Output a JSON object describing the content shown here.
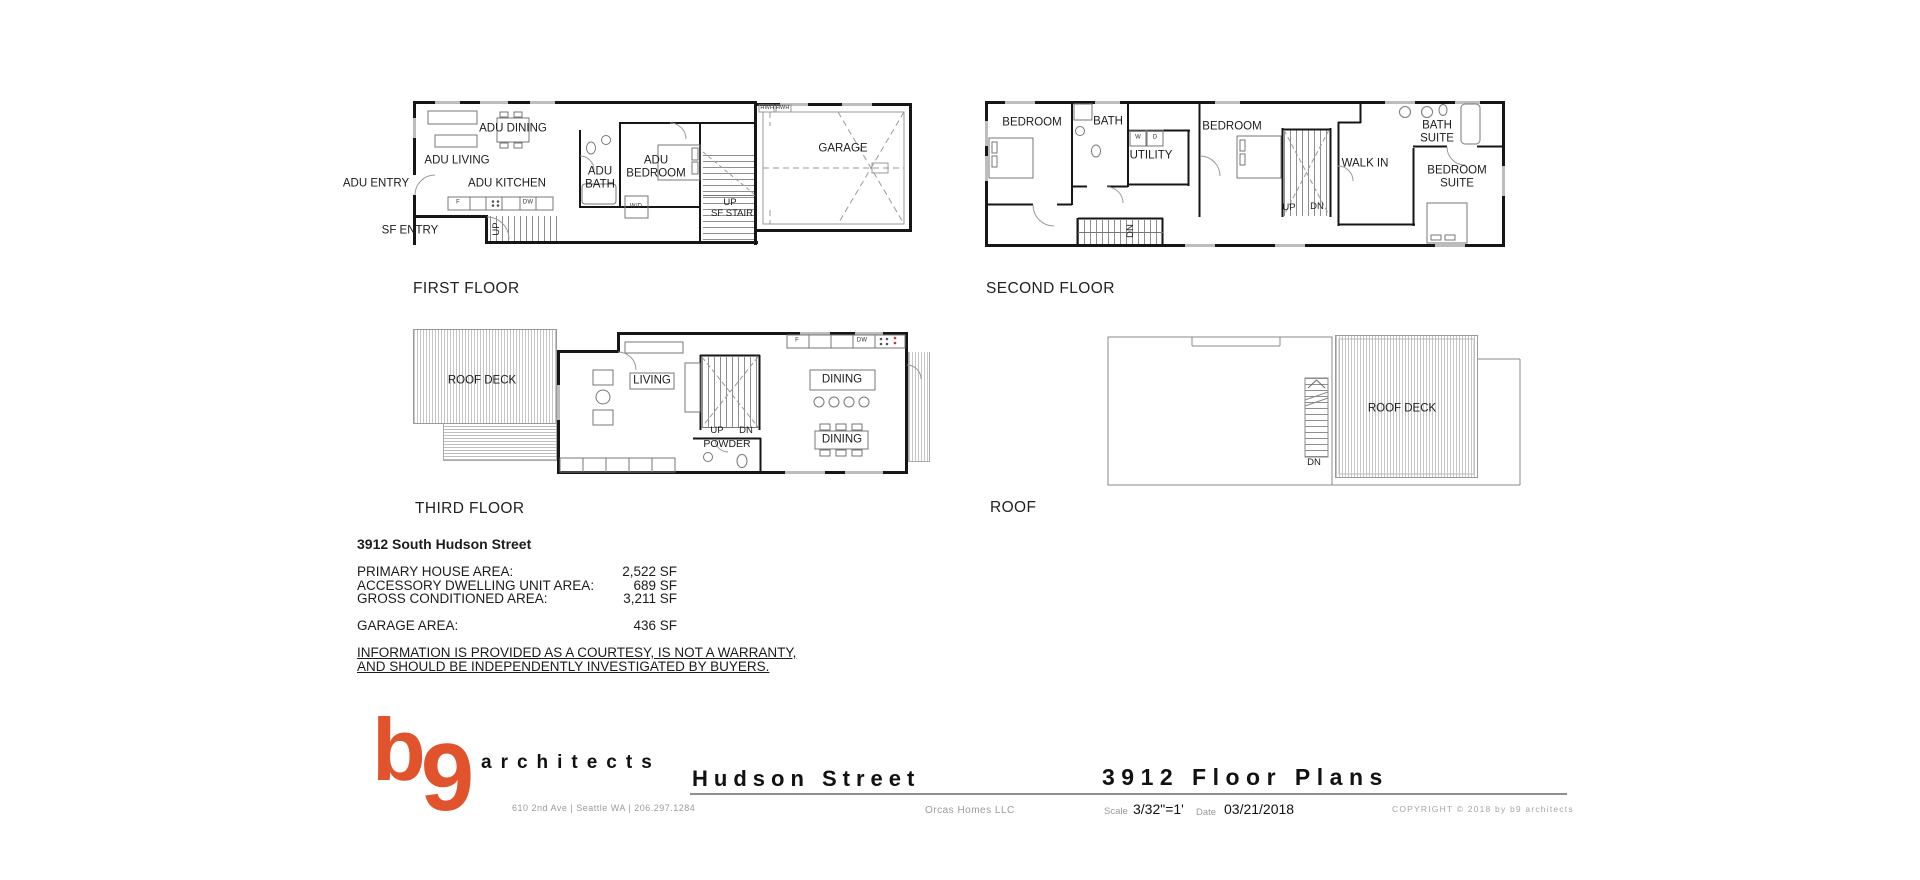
{
  "plans": {
    "first": {
      "caption": "FIRST FLOOR",
      "labels": {
        "adu_entry": "ADU ENTRY",
        "sf_entry": "SF ENTRY",
        "adu_living": "ADU LIVING",
        "adu_dining": "ADU DINING",
        "adu_kitchen": "ADU KITCHEN",
        "adu_bath": "ADU BATH",
        "adu_bedroom": "ADU BEDROOM",
        "up_entry": "UP",
        "sf_stair_up": "UP",
        "sf_stair": "SF STAIR",
        "garage": "GARAGE",
        "hwh": "HWH  HWH",
        "wd": "W/D",
        "fridge": "F",
        "dw": "DW"
      }
    },
    "second": {
      "caption": "SECOND FLOOR",
      "labels": {
        "bedroom_left": "BEDROOM",
        "bath": "BATH",
        "utility": "UTILITY",
        "bedroom_mid": "BEDROOM",
        "walk_in": "WALK IN",
        "bath_suite": "BATH SUITE",
        "bedroom_suite": "BEDROOM SUITE",
        "up": "UP",
        "dn": "DN",
        "dn_stair": "DN",
        "washer": "W",
        "dryer": "D"
      }
    },
    "third": {
      "caption": "THIRD FLOOR",
      "labels": {
        "roof_deck": "ROOF DECK",
        "living": "LIVING",
        "dining_island": "DINING",
        "dining_table": "DINING",
        "up": "UP",
        "dn": "DN",
        "powder": "POWDER",
        "fridge": "F",
        "dw": "DW"
      }
    },
    "roof": {
      "caption": "ROOF",
      "labels": {
        "roof_deck": "ROOF DECK",
        "dn": "DN"
      }
    }
  },
  "summary": {
    "address": "3912 South Hudson Street",
    "rows": [
      {
        "label": "PRIMARY HOUSE AREA:",
        "value": "2,522 SF"
      },
      {
        "label": "ACCESSORY DWELLING UNIT AREA:",
        "value": "689 SF"
      },
      {
        "label": "GROSS CONDITIONED AREA:",
        "value": "3,211 SF"
      }
    ],
    "garage_row": {
      "label": "GARAGE AREA:",
      "value": "436 SF"
    },
    "disclaimer_line1": "INFORMATION IS PROVIDED AS A COURTESY, IS NOT A WARRANTY,",
    "disclaimer_line2": "AND SHOULD BE INDEPENDENTLY INVESTIGATED BY BUYERS."
  },
  "titleblock": {
    "logo_b": "b",
    "logo_9": "9",
    "firm": "architects",
    "firm_address": "610 2nd Ave | Seattle WA | 206.297.1284",
    "project": "Hudson Street",
    "client": "Orcas Homes LLC",
    "sheet_title": "3912 Floor Plans",
    "scale_label": "Scale",
    "scale_value": "3/32\"=1'",
    "date_label": "Date",
    "date_value": "03/21/2018",
    "copyright": "COPYRIGHT © 2018 by b9 architects"
  },
  "colors": {
    "accent_orange": "#e1532d",
    "muted_gray": "#9a9a9a",
    "wall_black": "#161616"
  }
}
